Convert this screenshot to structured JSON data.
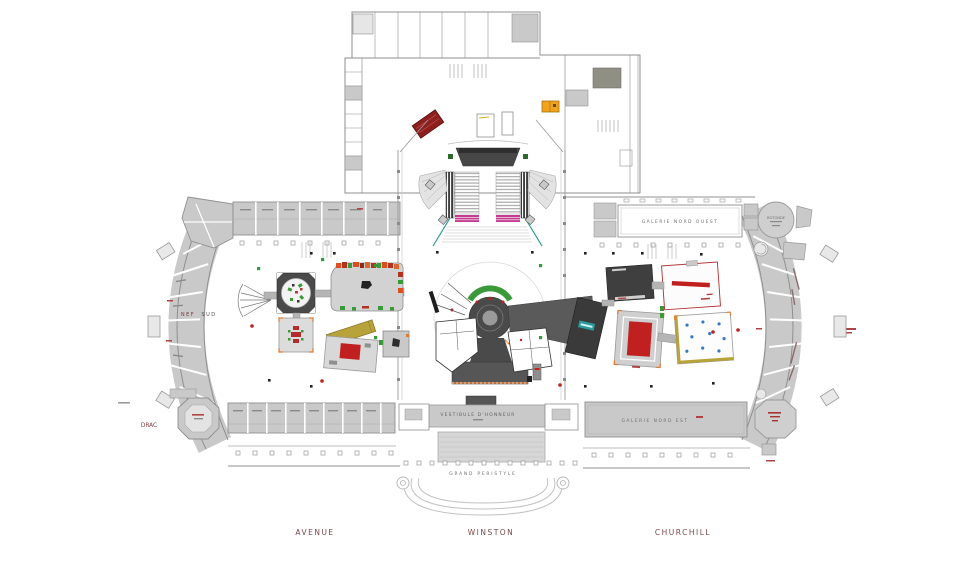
{
  "plan": {
    "type": "architectural-floor-plan",
    "labels": {
      "street_avenue": "AVENUE",
      "street_winston": "WINSTON",
      "street_churchill": "CHURCHILL",
      "drac": "DRAC",
      "nef": "NEF",
      "sud": "SUD",
      "galerie_nord_ouest": "GALERIE  NORD  OUEST",
      "galerie_nord_est": "GALERIE  NORD  EST",
      "vestibule_honneur": "VESTIBULE  D'HONNEUR",
      "grand_peristyle": "GRAND  PERISTYLE",
      "rotonde": "ROTONDE"
    },
    "colors": {
      "room_fill": "#c9c9c9",
      "wall_line": "#8f8f8f",
      "dark_stand": "#3f3f3f",
      "accent_red": "#c0201f",
      "accent_orange": "#e07a30",
      "accent_green": "#3a9a3a",
      "accent_magenta": "#c43b8f",
      "accent_teal": "#2a9a9a",
      "accent_olive": "#b8a23a",
      "accent_yellow": "#f2a31b",
      "street_label": "#7a4848",
      "room_label": "#6f6f6f"
    }
  }
}
